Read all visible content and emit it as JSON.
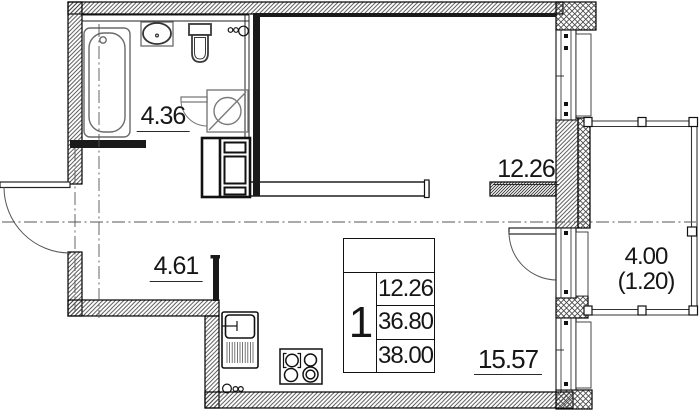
{
  "rooms": {
    "bathroom": {
      "area": "4.36"
    },
    "bedroom": {
      "area": "12.26"
    },
    "hallway": {
      "area": "4.61"
    },
    "kitchen_living": {
      "area": "15.57"
    },
    "balcony": {
      "area": "4.00",
      "area_with_coefficient": "(1.20)"
    }
  },
  "info_table": {
    "header": "",
    "rooms_count": "1",
    "rows": [
      "12.26",
      "36.80",
      "38.00"
    ]
  },
  "fixtures": [
    "bathtub",
    "wash-basin",
    "toilet",
    "washing-machine",
    "ventilation-shaft",
    "kitchen-sink",
    "stove",
    "entrance-door",
    "bathroom-door",
    "balcony-door",
    "window",
    "balcony-railing"
  ],
  "colors": {
    "line": "#141414",
    "hatch": "#444444",
    "partition": "#1a1a1a",
    "fixture_gray": "#6a6a6a",
    "background": "#ffffff"
  }
}
